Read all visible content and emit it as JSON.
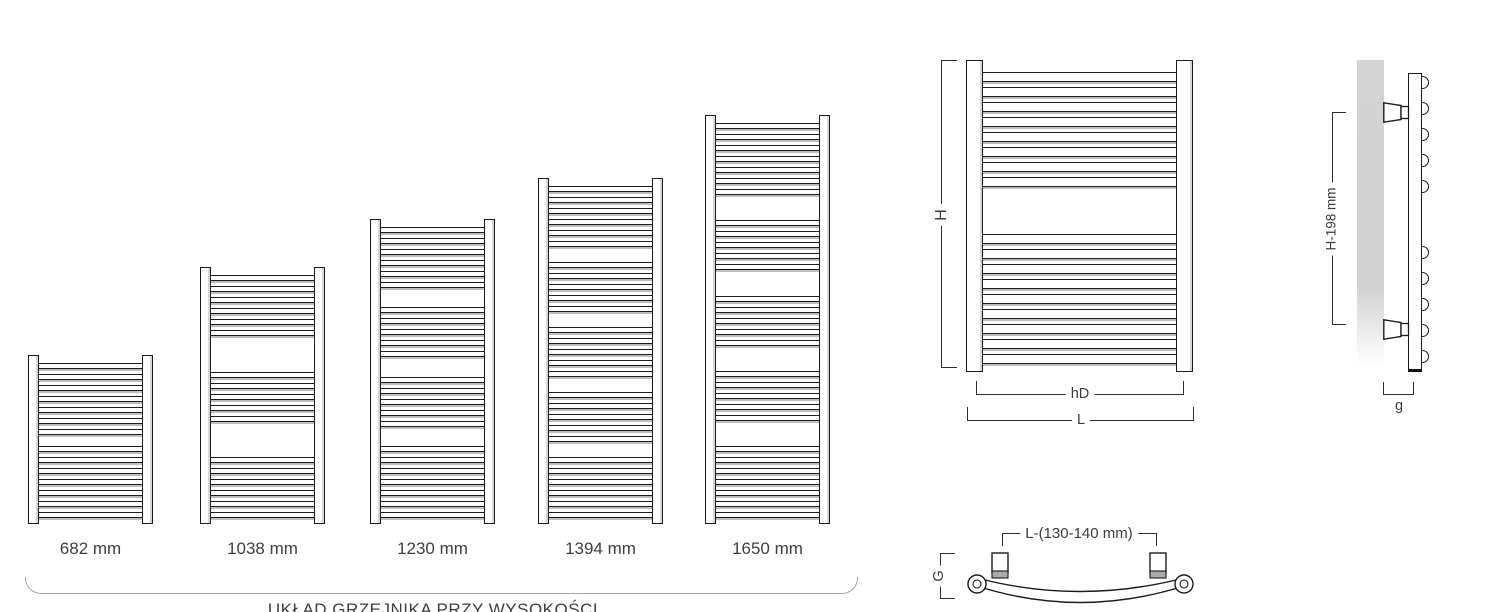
{
  "size_variants": {
    "items": [
      {
        "label": "682 mm"
      },
      {
        "label": "1038 mm"
      },
      {
        "label": "1230 mm"
      },
      {
        "label": "1394 mm"
      },
      {
        "label": "1650 mm"
      }
    ],
    "caption": "UKŁAD GRZEJNIKA PRZY WYSOKOŚCI"
  },
  "front_view": {
    "height_label": "H",
    "axis_width_label": "hD",
    "total_width_label": "L"
  },
  "side_view": {
    "bracket_spacing_label": "H-198 mm",
    "depth_label": "g"
  },
  "top_view": {
    "bracket_distance_label": "L-(130-140 mm)",
    "depth_label": "G"
  },
  "colors": {
    "line": "#1c1c1c",
    "dimension_line": "#2e2e2e",
    "text": "#3c3c3c",
    "wall_shade": "#d3d3d3",
    "background": "#ffffff"
  }
}
